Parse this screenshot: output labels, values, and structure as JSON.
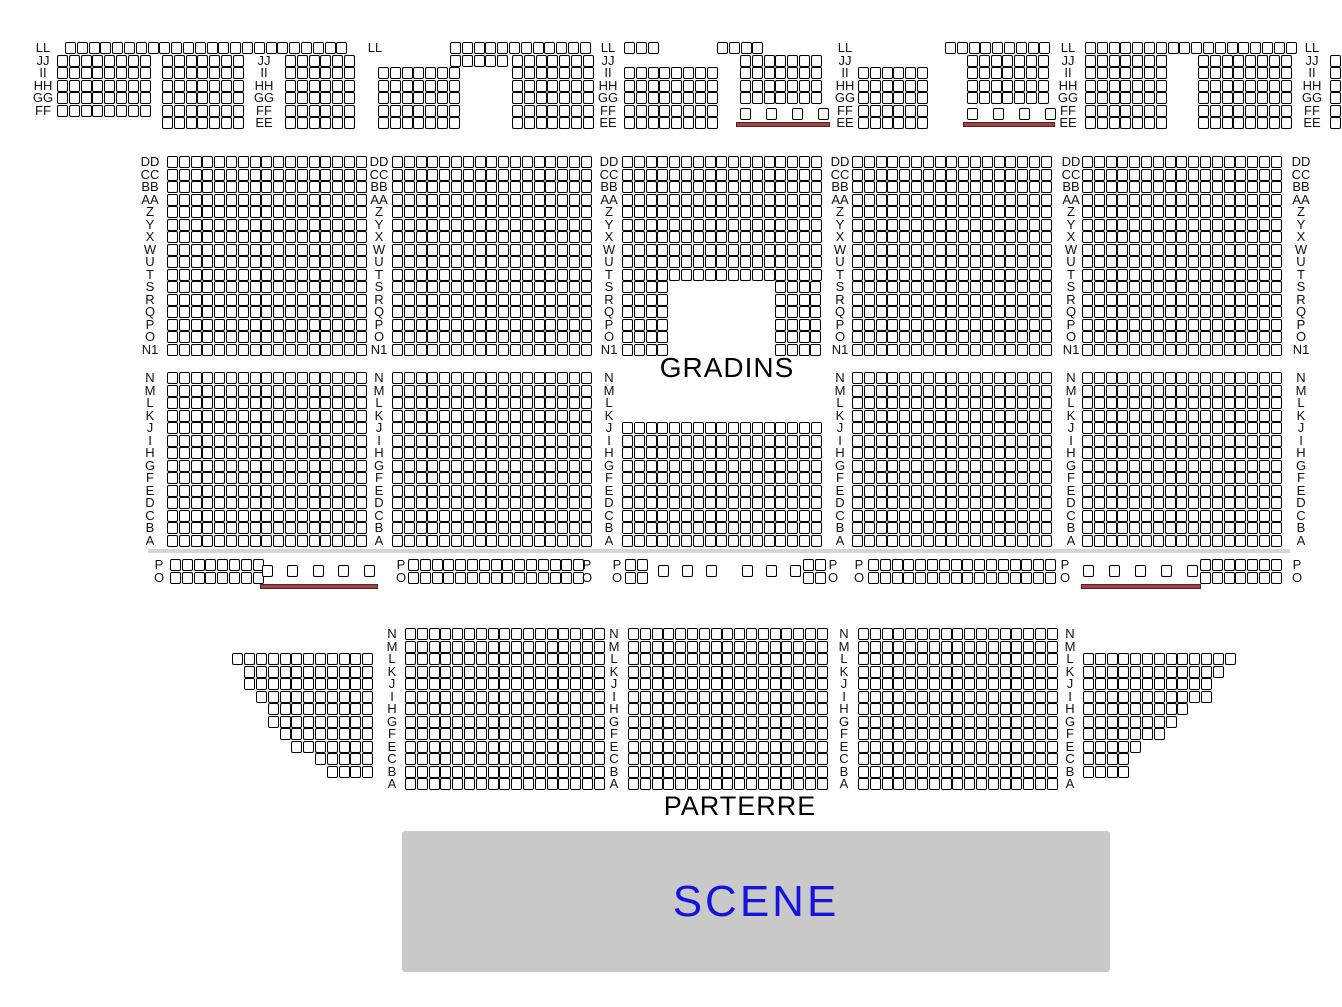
{
  "map": {
    "texts": {
      "gradins": "GRADINS",
      "parterre": "PARTERRE",
      "scene": "SCENE"
    },
    "colors": {
      "seat_fill": "#ffffff",
      "seat_border": "#000000",
      "label_text": "#111111",
      "underline": "#9c4646",
      "underline_border": "#5e1e1e",
      "divider": "#d5d5d5",
      "scene_fill": "#c9c9c9",
      "scene_text": "#1414dd"
    },
    "geometry": {
      "seat_w": 9,
      "seat_h": 10,
      "pitch_x": 11.8,
      "pitch_y": 12.5
    },
    "divider": {
      "x": 148,
      "y": 549,
      "w": 1142,
      "h": 4
    },
    "scene_box": {
      "x": 402,
      "y": 831,
      "w": 708,
      "h": 141
    },
    "label_columns": [
      {
        "x": 30,
        "y": 42,
        "lines": [
          "LL",
          "JJ",
          "II",
          "HH",
          "GG",
          "FF"
        ]
      },
      {
        "x": 251,
        "y": 54.5,
        "lines": [
          "JJ",
          "II",
          "HH",
          "GG",
          "FF",
          "EE"
        ]
      },
      {
        "x": 362,
        "y": 42,
        "lines": [
          "LL"
        ]
      },
      {
        "x": 595,
        "y": 42,
        "lines": [
          "LL",
          "JJ",
          "II",
          "HH",
          "GG",
          "FF",
          "EE"
        ]
      },
      {
        "x": 832,
        "y": 42,
        "lines": [
          "LL",
          "JJ",
          "II",
          "HH",
          "GG",
          "FF",
          "EE"
        ]
      },
      {
        "x": 1055,
        "y": 42,
        "lines": [
          "LL",
          "JJ",
          "II",
          "HH",
          "GG",
          "FF",
          "EE"
        ]
      },
      {
        "x": 1299,
        "y": 42,
        "lines": [
          "LL",
          "JJ",
          "II",
          "HH",
          "GG",
          "FF",
          "EE"
        ]
      },
      {
        "x": 137,
        "y": 156,
        "lines": [
          "DD",
          "CC",
          "BB",
          "AA",
          "Z",
          "Y",
          "X",
          "W",
          "U",
          "T",
          "S",
          "R",
          "Q",
          "P",
          "O",
          "N1"
        ]
      },
      {
        "x": 366,
        "y": 156,
        "lines": [
          "DD",
          "CC",
          "BB",
          "AA",
          "Z",
          "Y",
          "X",
          "W",
          "U",
          "T",
          "S",
          "R",
          "Q",
          "P",
          "O",
          "N1"
        ]
      },
      {
        "x": 596,
        "y": 156,
        "lines": [
          "DD",
          "CC",
          "BB",
          "AA",
          "Z",
          "Y",
          "X",
          "W",
          "U",
          "T",
          "S",
          "R",
          "Q",
          "P",
          "O",
          "N1"
        ]
      },
      {
        "x": 827,
        "y": 156,
        "lines": [
          "DD",
          "CC",
          "BB",
          "AA",
          "Z",
          "Y",
          "X",
          "W",
          "U",
          "T",
          "S",
          "R",
          "Q",
          "P",
          "O",
          "N1"
        ]
      },
      {
        "x": 1058,
        "y": 156,
        "lines": [
          "DD",
          "CC",
          "BB",
          "AA",
          "Z",
          "Y",
          "X",
          "W",
          "U",
          "T",
          "S",
          "R",
          "Q",
          "P",
          "O",
          "N1"
        ]
      },
      {
        "x": 1288,
        "y": 156,
        "lines": [
          "DD",
          "CC",
          "BB",
          "AA",
          "Z",
          "Y",
          "X",
          "W",
          "U",
          "T",
          "S",
          "R",
          "Q",
          "P",
          "O",
          "N1"
        ]
      },
      {
        "x": 137,
        "y": 372,
        "lines": [
          "N",
          "M",
          "L",
          "K",
          "J",
          "I",
          "H",
          "G",
          "F",
          "E",
          "D",
          "C",
          "B",
          "A"
        ]
      },
      {
        "x": 366,
        "y": 372,
        "lines": [
          "N",
          "M",
          "L",
          "K",
          "J",
          "I",
          "H",
          "G",
          "F",
          "E",
          "D",
          "C",
          "B",
          "A"
        ]
      },
      {
        "x": 596,
        "y": 372,
        "lines": [
          "N",
          "M",
          "L",
          "K",
          "J",
          "I",
          "H",
          "G",
          "F",
          "E",
          "D",
          "C",
          "B",
          "A"
        ]
      },
      {
        "x": 827,
        "y": 372,
        "lines": [
          "N",
          "M",
          "L",
          "K",
          "J",
          "I",
          "H",
          "G",
          "F",
          "E",
          "D",
          "C",
          "B",
          "A"
        ]
      },
      {
        "x": 1058,
        "y": 372,
        "lines": [
          "N",
          "M",
          "L",
          "K",
          "J",
          "I",
          "H",
          "G",
          "F",
          "E",
          "D",
          "C",
          "B",
          "A"
        ]
      },
      {
        "x": 1288,
        "y": 372,
        "lines": [
          "N",
          "M",
          "L",
          "K",
          "J",
          "I",
          "H",
          "G",
          "F",
          "E",
          "D",
          "C",
          "B",
          "A"
        ]
      },
      {
        "x": 146,
        "y": 559,
        "lines": [
          "P",
          "O"
        ]
      },
      {
        "x": 388,
        "y": 559,
        "lines": [
          "P",
          "O"
        ]
      },
      {
        "x": 574,
        "y": 559,
        "lines": [
          "P",
          "O"
        ]
      },
      {
        "x": 604,
        "y": 559,
        "lines": [
          "P",
          "O"
        ]
      },
      {
        "x": 820,
        "y": 559,
        "lines": [
          "P",
          "O"
        ]
      },
      {
        "x": 846,
        "y": 559,
        "lines": [
          "P",
          "O"
        ]
      },
      {
        "x": 1052,
        "y": 559,
        "lines": [
          "P",
          "O"
        ]
      },
      {
        "x": 1284,
        "y": 559,
        "lines": [
          "P",
          "O"
        ]
      },
      {
        "x": 379,
        "y": 628,
        "lines": [
          "N",
          "M",
          "L",
          "K",
          "J",
          "I",
          "H",
          "G",
          "F",
          "E",
          "C",
          "B",
          "A"
        ]
      },
      {
        "x": 601,
        "y": 628,
        "lines": [
          "N",
          "M",
          "L",
          "K",
          "J",
          "I",
          "H",
          "G",
          "F",
          "E",
          "C",
          "B",
          "A"
        ]
      },
      {
        "x": 831,
        "y": 628,
        "lines": [
          "N",
          "M",
          "L",
          "K",
          "J",
          "I",
          "H",
          "G",
          "F",
          "E",
          "C",
          "B",
          "A"
        ]
      },
      {
        "x": 1057,
        "y": 628,
        "lines": [
          "N",
          "M",
          "L",
          "K",
          "J",
          "I",
          "H",
          "G",
          "F",
          "E",
          "C",
          "B",
          "A"
        ]
      }
    ],
    "seat_blocks": [
      {
        "x": 65,
        "y": 42,
        "rows": 1,
        "cols": 24
      },
      {
        "x": 57,
        "y": 54.5,
        "rows": 5,
        "cols": 8
      },
      {
        "x": 162,
        "y": 54.5,
        "rows": 6,
        "cols": 7
      },
      {
        "x": 285,
        "y": 54.5,
        "rows": 6,
        "cols": 6
      },
      {
        "x": 378,
        "y": 67,
        "rows": 5,
        "cols": 7
      },
      {
        "x": 450,
        "y": 42,
        "rows": 1,
        "cols": 12
      },
      {
        "x": 450,
        "y": 54.5,
        "rows": 1,
        "cols": 5
      },
      {
        "x": 512,
        "y": 54.5,
        "rows": 6,
        "cols": 7
      },
      {
        "x": 624,
        "y": 42,
        "rows": 1,
        "cols": 3
      },
      {
        "x": 624,
        "y": 67,
        "rows": 5,
        "cols": 8
      },
      {
        "x": 717,
        "y": 42,
        "rows": 1,
        "cols": 4
      },
      {
        "x": 740,
        "y": 54.5,
        "rows": 4,
        "cols": 7
      },
      {
        "x": 858,
        "y": 67,
        "rows": 5,
        "cols": 6
      },
      {
        "x": 945,
        "y": 42,
        "rows": 1,
        "cols": 9
      },
      {
        "x": 967,
        "y": 54.5,
        "rows": 4,
        "cols": 7
      },
      {
        "x": 1085,
        "y": 42,
        "rows": 1,
        "cols": 18
      },
      {
        "x": 1085,
        "y": 54.5,
        "rows": 6,
        "cols": 7
      },
      {
        "x": 1198,
        "y": 54.5,
        "rows": 6,
        "cols": 8
      },
      {
        "x": 1330,
        "y": 54.5,
        "rows": 6,
        "cols": 2
      },
      {
        "x": 167,
        "y": 156,
        "rows": 16,
        "cols": 17
      },
      {
        "x": 392,
        "y": 156,
        "rows": 16,
        "cols": 17
      },
      {
        "x": 622,
        "y": 156,
        "rows": 10,
        "cols": 17
      },
      {
        "x": 622,
        "y": 281,
        "rows": 6,
        "cols": 4
      },
      {
        "x": 775,
        "y": 281,
        "rows": 6,
        "cols": 4
      },
      {
        "x": 852,
        "y": 156,
        "rows": 16,
        "cols": 17
      },
      {
        "x": 1082,
        "y": 156,
        "rows": 16,
        "cols": 17
      },
      {
        "x": 167,
        "y": 372,
        "rows": 14,
        "cols": 17
      },
      {
        "x": 392,
        "y": 372,
        "rows": 14,
        "cols": 17
      },
      {
        "x": 622,
        "y": 422,
        "rows": 10,
        "cols": 17
      },
      {
        "x": 852,
        "y": 372,
        "rows": 14,
        "cols": 17
      },
      {
        "x": 1082,
        "y": 372,
        "rows": 14,
        "cols": 17
      },
      {
        "x": 170,
        "y": 559,
        "rows": 2,
        "cols": 8
      },
      {
        "x": 408,
        "y": 559,
        "rows": 2,
        "cols": 15
      },
      {
        "x": 625,
        "y": 559,
        "rows": 2,
        "cols": 2
      },
      {
        "x": 803,
        "y": 559,
        "rows": 2,
        "cols": 2
      },
      {
        "x": 868,
        "y": 559,
        "rows": 2,
        "cols": 16
      },
      {
        "x": 1200,
        "y": 559,
        "rows": 2,
        "cols": 7
      },
      {
        "x": 405,
        "y": 628,
        "rows": 13,
        "cols": 17
      },
      {
        "x": 628,
        "y": 628,
        "rows": 13,
        "cols": 17
      },
      {
        "x": 858,
        "y": 628,
        "rows": 13,
        "cols": 17
      },
      {
        "x": 374,
        "y": 653,
        "align": "right",
        "row_counts": [
          12,
          11,
          11,
          10,
          9,
          9,
          8,
          7,
          5,
          4
        ]
      },
      {
        "x": 1083,
        "y": 653,
        "align": "left",
        "row_counts": [
          13,
          12,
          11,
          11,
          9,
          8,
          7,
          5,
          4,
          4
        ]
      }
    ],
    "spaced_seats": [
      {
        "y": 108,
        "xs": [
          740,
          766,
          792,
          818
        ]
      },
      {
        "y": 108,
        "xs": [
          967,
          993,
          1019,
          1045
        ]
      },
      {
        "y": 565,
        "xs": [
          262,
          287,
          313,
          338,
          364
        ]
      },
      {
        "y": 565,
        "xs": [
          658,
          682,
          706
        ]
      },
      {
        "y": 565,
        "xs": [
          742,
          766,
          790
        ]
      },
      {
        "y": 565,
        "xs": [
          1083,
          1109,
          1135,
          1161,
          1187
        ]
      }
    ],
    "underlines": [
      {
        "x": 736,
        "y": 122,
        "w": 92
      },
      {
        "x": 963,
        "y": 122,
        "w": 90
      },
      {
        "x": 260,
        "y": 584,
        "w": 116
      },
      {
        "x": 1081,
        "y": 584,
        "w": 118
      }
    ]
  }
}
